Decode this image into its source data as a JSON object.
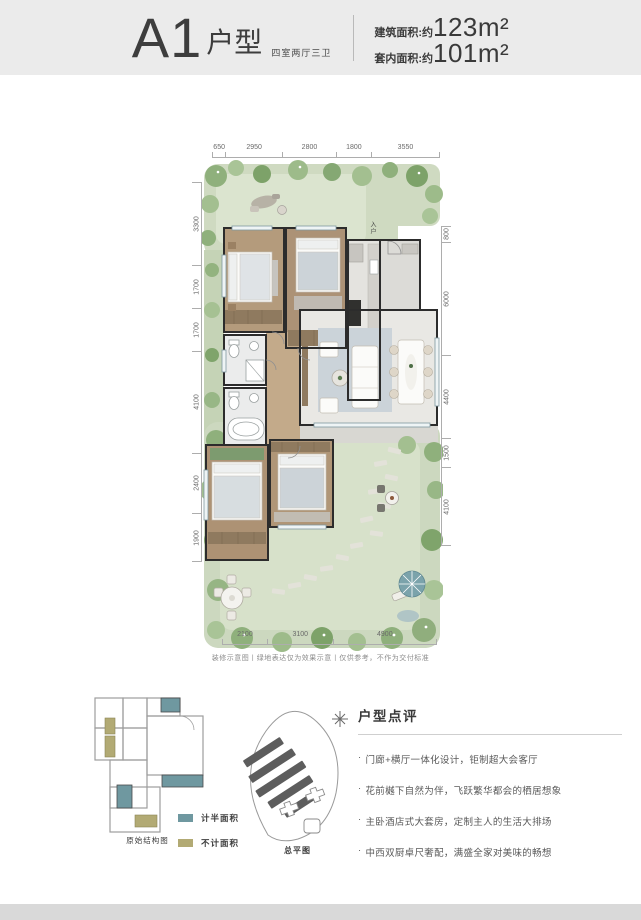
{
  "header": {
    "title": "A1",
    "title_suffix": "户型",
    "subtitle": "四室两厅三卫",
    "area_items": [
      {
        "label": "建筑面积:约",
        "value": "123m²"
      },
      {
        "label": "套内面积:约",
        "value": "101m²"
      }
    ]
  },
  "plan": {
    "entry_label": "入户",
    "dims_top": [
      "650",
      "2950",
      "2800",
      "1800",
      "3550"
    ],
    "dims_left": [
      "3300",
      "1700",
      "1700",
      "4100",
      "2400",
      "1900"
    ],
    "dims_right": [
      "800",
      "6000",
      "4400",
      "1500",
      "4100"
    ],
    "dims_bottom": [
      "2100",
      "3100",
      "4900"
    ],
    "disclaimer": "装修示意图丨绿地表达仅为效果示意丨仅供参考，不作为交付标准"
  },
  "structure_plan": {
    "caption": "原始结构图"
  },
  "legend": {
    "items": [
      {
        "label": "计半面积",
        "color": "#6f98a0"
      },
      {
        "label": "不计面积",
        "color": "#b2aa74"
      }
    ]
  },
  "site_plan": {
    "caption": "总平图"
  },
  "review": {
    "title": "户型点评",
    "bullet_marker": "·",
    "bullets": [
      "门廊+横厅一体化设计，钜制超大会客厅",
      "花前樾下自然为伴，飞跃繁华都会的栖居想象",
      "主卧酒店式大套房，定制主人的生活大排场",
      "中西双厨卓尺奢配，满盛全家对美味的畅想"
    ]
  },
  "colors": {
    "header_band": "#ebebeb",
    "footer_band": "#d9d9d9",
    "garden_green": "#cfdac1",
    "wood_floor": "#b49b7c",
    "legend_teal": "#6f98a0",
    "legend_olive": "#b2aa74"
  }
}
